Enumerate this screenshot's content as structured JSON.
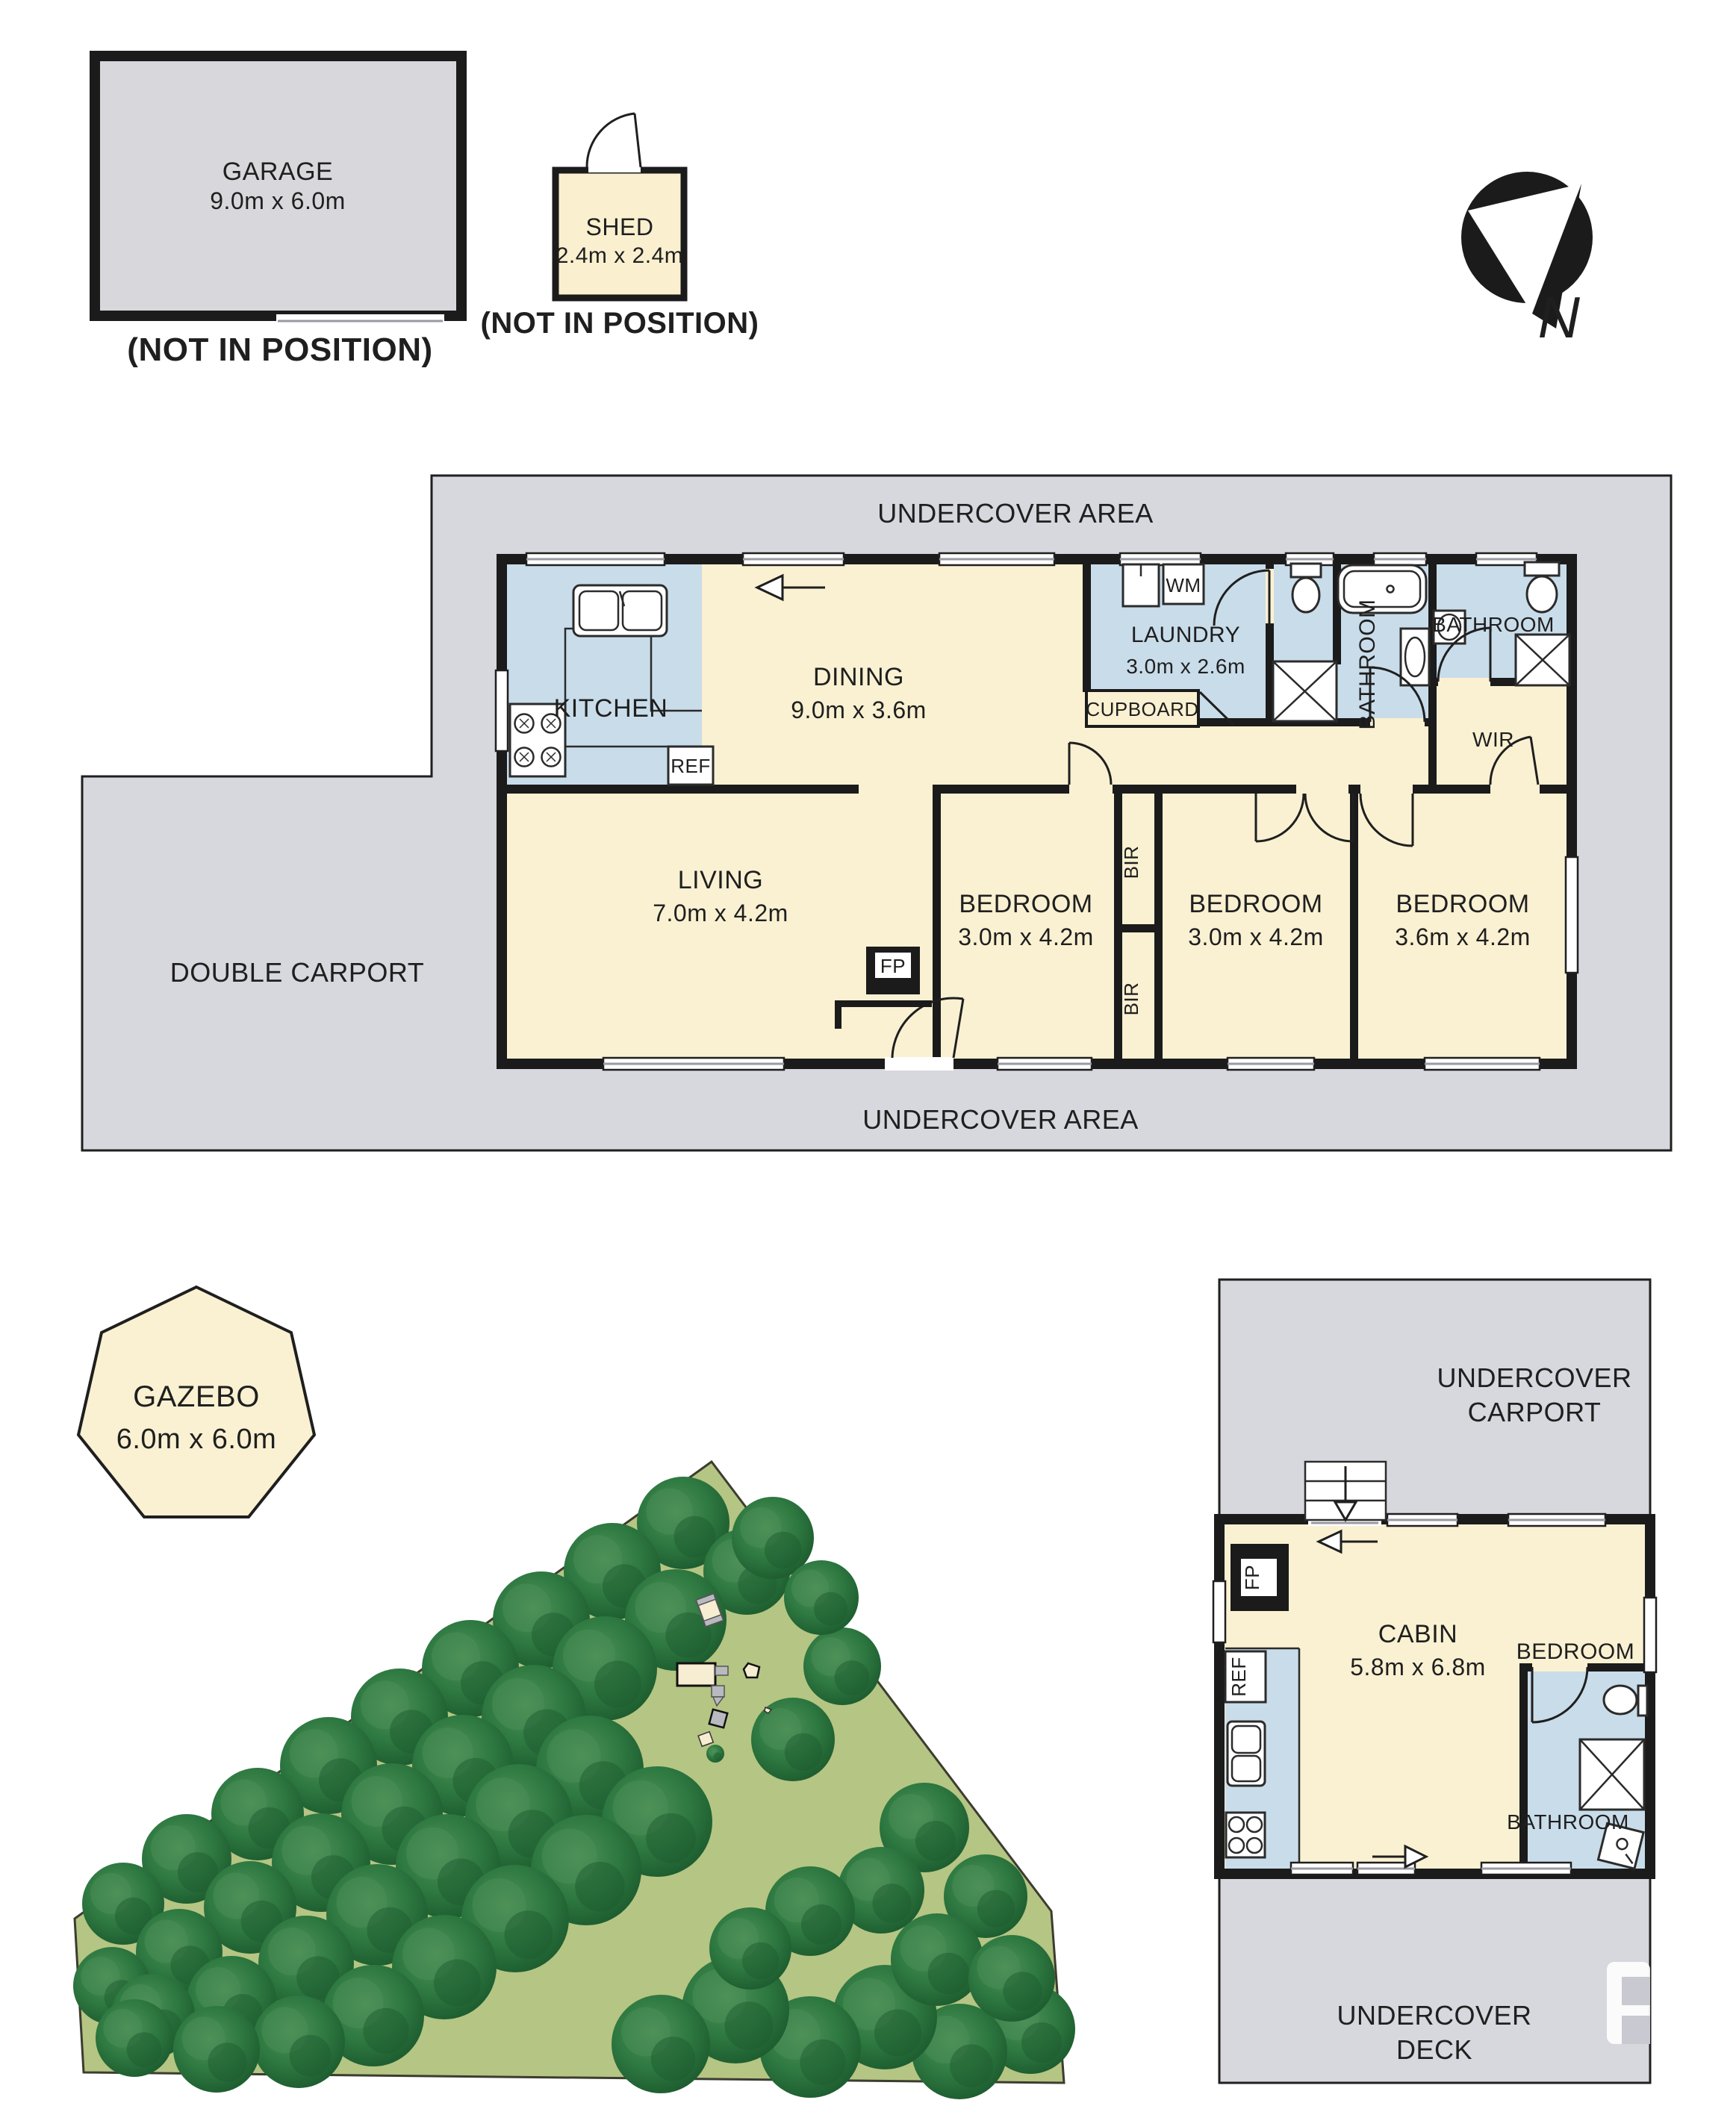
{
  "palette": {
    "cream": "#FAF1D2",
    "blue": "#C9DCEA",
    "gray": "#D7D7DE",
    "wall": "#1B1B1B",
    "green": "#B5C583",
    "tree_dark": "#1D5C2F",
    "tree_mid": "#2F7A42",
    "tree_light": "#4E9159"
  },
  "garage": {
    "label": "GARAGE",
    "dims": "9.0m x 6.0m",
    "note": "(NOT IN POSITION)"
  },
  "shed": {
    "label": "SHED",
    "dims": "2.4m x 2.4m",
    "note": "(NOT IN POSITION)"
  },
  "compass": {
    "label": "N"
  },
  "main_floor": {
    "undercover_top": "UNDERCOVER AREA",
    "undercover_bottom": "UNDERCOVER AREA",
    "double_carport": "DOUBLE CARPORT",
    "kitchen": {
      "label": "KITCHEN"
    },
    "ref": "REF",
    "dining": {
      "label": "DINING",
      "dims": "9.0m x 3.6m"
    },
    "laundry": {
      "label": "LAUNDRY",
      "dims": "3.0m x 2.6m"
    },
    "wm": "WM",
    "cupboard": "CUPBOARD",
    "bathroom1": {
      "label": "BATHROOM"
    },
    "bathroom2": {
      "label": "BATHROOM"
    },
    "wir": "WIR",
    "living": {
      "label": "LIVING",
      "dims": "7.0m x 4.2m"
    },
    "fp": "FP",
    "bedroom1": {
      "label": "BEDROOM",
      "dims": "3.0m x 4.2m"
    },
    "bedroom2": {
      "label": "BEDROOM",
      "dims": "3.0m x 4.2m"
    },
    "bedroom3": {
      "label": "BEDROOM",
      "dims": "3.6m x 4.2m"
    },
    "bir1": "BIR",
    "bir2": "BIR"
  },
  "gazebo": {
    "label": "GAZEBO",
    "dims": "6.0m x 6.0m"
  },
  "cabin_area": {
    "carport_line1": "UNDERCOVER",
    "carport_line2": "CARPORT",
    "cabin": {
      "label": "CABIN",
      "dims": "5.8m x 6.8m"
    },
    "bedroom": "BEDROOM",
    "bathroom": "BATHROOM",
    "ref": "REF",
    "fp": "FP",
    "deck_line1": "UNDERCOVER",
    "deck_line2": "DECK"
  },
  "orchard": {
    "trees": [
      [
        915,
        2040,
        62
      ],
      [
        820,
        2105,
        65
      ],
      [
        725,
        2170,
        65
      ],
      [
        630,
        2235,
        65
      ],
      [
        535,
        2300,
        65
      ],
      [
        440,
        2365,
        65
      ],
      [
        345,
        2430,
        62
      ],
      [
        250,
        2490,
        60
      ],
      [
        165,
        2550,
        55
      ],
      [
        1000,
        2105,
        58
      ],
      [
        905,
        2170,
        68
      ],
      [
        810,
        2235,
        70
      ],
      [
        715,
        2300,
        70
      ],
      [
        620,
        2365,
        68
      ],
      [
        525,
        2430,
        68
      ],
      [
        430,
        2495,
        66
      ],
      [
        335,
        2555,
        62
      ],
      [
        240,
        2615,
        58
      ],
      [
        150,
        2660,
        52
      ],
      [
        790,
        2370,
        72
      ],
      [
        695,
        2435,
        72
      ],
      [
        600,
        2500,
        70
      ],
      [
        505,
        2565,
        68
      ],
      [
        410,
        2630,
        64
      ],
      [
        310,
        2680,
        60
      ],
      [
        205,
        2700,
        56
      ],
      [
        880,
        2440,
        74
      ],
      [
        785,
        2505,
        74
      ],
      [
        690,
        2570,
        72
      ],
      [
        595,
        2635,
        70
      ],
      [
        500,
        2700,
        68
      ],
      [
        400,
        2735,
        62
      ],
      [
        290,
        2745,
        58
      ],
      [
        180,
        2730,
        52
      ],
      [
        1380,
        2718,
        60
      ],
      [
        1285,
        2748,
        64
      ],
      [
        1185,
        2702,
        70
      ],
      [
        1085,
        2742,
        68
      ],
      [
        985,
        2692,
        72
      ],
      [
        885,
        2738,
        66
      ],
      [
        1128,
        2232,
        52
      ],
      [
        1062,
        2330,
        56
      ],
      [
        1238,
        2448,
        60
      ],
      [
        1320,
        2540,
        56
      ],
      [
        1180,
        2532,
        58
      ],
      [
        1255,
        2625,
        62
      ],
      [
        1355,
        2650,
        58
      ],
      [
        1085,
        2560,
        60
      ],
      [
        1005,
        2610,
        55
      ],
      [
        1035,
        2060,
        55
      ],
      [
        1100,
        2140,
        50
      ],
      [
        958,
        2349,
        12
      ]
    ]
  }
}
